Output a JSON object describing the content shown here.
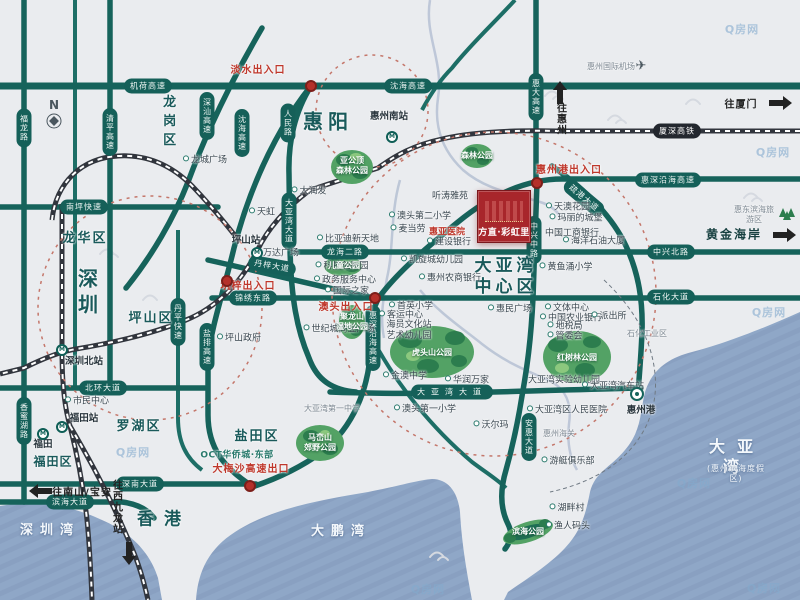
{
  "project": {
    "name": "方直·彩虹里"
  },
  "compass": {
    "label": "N"
  },
  "icons": {
    "plane": "✈"
  },
  "watermark": {
    "text": "Q房网",
    "positions": [
      [
        742,
        29
      ],
      [
        773,
        152
      ],
      [
        769,
        312
      ],
      [
        694,
        483
      ],
      [
        133,
        452
      ],
      [
        428,
        589
      ],
      [
        764,
        588
      ]
    ]
  },
  "airport": {
    "label": "惠州国际机场",
    "x": 611,
    "y": 67,
    "ix": 641,
    "iy": 66
  },
  "regions": [
    {
      "label": "惠阳",
      "x": 328,
      "y": 122,
      "cls": "xl"
    },
    {
      "label": "深圳",
      "x": 86,
      "y": 294,
      "cls": "xl v"
    },
    {
      "label": "龙岗区",
      "x": 167,
      "y": 123,
      "cls": "md v"
    },
    {
      "label": "龙华区",
      "x": 85,
      "y": 239,
      "cls": "md"
    },
    {
      "label": "坪山区",
      "x": 151,
      "y": 319,
      "cls": "md"
    },
    {
      "label": "罗湖区",
      "x": 139,
      "y": 427,
      "cls": "md"
    },
    {
      "label": "福田区",
      "x": 53,
      "y": 462,
      "cls": "sm"
    },
    {
      "label": "盐田区",
      "x": 257,
      "y": 437,
      "cls": "md"
    },
    {
      "label": "香港",
      "x": 164,
      "y": 520,
      "cls": "lg"
    },
    {
      "label": "大亚湾\n中心区",
      "x": 506,
      "y": 277,
      "cls": "center"
    }
  ],
  "water_labels": [
    {
      "label": "深圳湾",
      "x": 50,
      "y": 531
    },
    {
      "label": "大鹏湾",
      "x": 341,
      "y": 532
    },
    {
      "label": "大亚湾",
      "x": 737,
      "y": 457,
      "big": true
    },
    {
      "label": "(惠州滨海度假区)",
      "x": 736,
      "y": 474,
      "sub": true
    }
  ],
  "road_labels": [
    {
      "label": "机荷高速",
      "x": 148,
      "y": 86,
      "o": "h"
    },
    {
      "label": "沈海高速",
      "x": 408,
      "y": 86,
      "o": "h"
    },
    {
      "label": "南坪快速",
      "x": 84,
      "y": 207,
      "o": "h"
    },
    {
      "label": "北环大道",
      "x": 103,
      "y": 388,
      "o": "h"
    },
    {
      "label": "深南大道",
      "x": 140,
      "y": 484,
      "o": "h"
    },
    {
      "label": "滨海大道",
      "x": 70,
      "y": 502,
      "o": "h"
    },
    {
      "label": "惠深沿海高速",
      "x": 668,
      "y": 180,
      "o": "h"
    },
    {
      "label": "中兴北路",
      "x": 671,
      "y": 252,
      "o": "h"
    },
    {
      "label": "石化大道",
      "x": 671,
      "y": 297,
      "o": "h"
    },
    {
      "label": "龙海二路",
      "x": 345,
      "y": 252,
      "o": "h"
    },
    {
      "label": "锦绣东路",
      "x": 253,
      "y": 298,
      "o": "h"
    },
    {
      "label": "大亚湾大道",
      "x": 452,
      "y": 392,
      "o": "h",
      "sp": true
    },
    {
      "label": "疏港大道",
      "x": 584,
      "y": 198,
      "o": "h",
      "rot": 40
    },
    {
      "label": "丹梓大道",
      "x": 272,
      "y": 266,
      "o": "h",
      "rot": 10
    },
    {
      "label": "人民路",
      "x": 288,
      "y": 123,
      "o": "v"
    },
    {
      "label": "大亚湾大道",
      "x": 289,
      "y": 221,
      "o": "v"
    },
    {
      "label": "沈海高速",
      "x": 242,
      "y": 133,
      "o": "v"
    },
    {
      "label": "深汕高速",
      "x": 207,
      "y": 116,
      "o": "v"
    },
    {
      "label": "清平高速",
      "x": 110,
      "y": 132,
      "o": "v"
    },
    {
      "label": "福龙路",
      "x": 24,
      "y": 128,
      "o": "v"
    },
    {
      "label": "香蜜湖路",
      "x": 24,
      "y": 421,
      "o": "v"
    },
    {
      "label": "丹平快速",
      "x": 178,
      "y": 322,
      "o": "v"
    },
    {
      "label": "盐排高速",
      "x": 207,
      "y": 347,
      "o": "v"
    },
    {
      "label": "惠大高速",
      "x": 536,
      "y": 97,
      "o": "v"
    },
    {
      "label": "中兴中路",
      "x": 534,
      "y": 240,
      "o": "v"
    },
    {
      "label": "安惠大道",
      "x": 529,
      "y": 437,
      "o": "v"
    },
    {
      "label": "惠深沿海高速",
      "x": 373,
      "y": 338,
      "o": "v"
    }
  ],
  "rail_labels": [
    {
      "label": "厦深高铁",
      "x": 677,
      "y": 131
    }
  ],
  "entrances": [
    {
      "label": "淡水出入口",
      "x": 258,
      "y": 71,
      "dx": 311,
      "dy": 86
    },
    {
      "label": "惠州港出入口",
      "x": 569,
      "y": 171,
      "dx": 537,
      "dy": 183
    },
    {
      "label": "澳头出入口",
      "x": 346,
      "y": 308,
      "dx": 375,
      "dy": 298
    },
    {
      "label": "坑梓出入口",
      "x": 248,
      "y": 287,
      "dx": 227,
      "dy": 281
    },
    {
      "label": "大梅沙高速出口",
      "x": 251,
      "y": 470,
      "dx": 250,
      "dy": 486
    }
  ],
  "stations": [
    {
      "label": "惠州南站",
      "x": 389,
      "y": 117,
      "ix": 392,
      "iy": 137
    },
    {
      "label": "坪山站",
      "x": 246,
      "y": 241,
      "ix": 257,
      "iy": 253
    },
    {
      "label": "深圳北站",
      "x": 84,
      "y": 362,
      "ix": 62,
      "iy": 350
    },
    {
      "label": "福田站",
      "x": 84,
      "y": 419,
      "ix": 62,
      "iy": 427
    },
    {
      "label": "福田",
      "x": 43,
      "y": 445,
      "ix": 43,
      "iy": 434
    },
    {
      "label": "惠州港",
      "x": 641,
      "y": 411,
      "ix": 637,
      "iy": 394,
      "red": true,
      "icon": "port"
    }
  ],
  "pois": [
    {
      "label": "龙城广场",
      "x": 205,
      "y": 161
    },
    {
      "label": "天虹",
      "x": 262,
      "y": 213
    },
    {
      "label": "大润发",
      "x": 309,
      "y": 192
    },
    {
      "label": "万达广场",
      "x": 277,
      "y": 254
    },
    {
      "label": "坪山政府",
      "x": 239,
      "y": 339
    },
    {
      "label": "市民中心",
      "x": 87,
      "y": 402
    },
    {
      "label": "比亚迪新天地",
      "x": 348,
      "y": 240
    },
    {
      "label": "科技创新园",
      "x": 342,
      "y": 267
    },
    {
      "label": "政务服务中心",
      "x": 345,
      "y": 281
    },
    {
      "label": "国际之家",
      "x": 347,
      "y": 292
    },
    {
      "label": "世纪城商业广场",
      "x": 339,
      "y": 330
    },
    {
      "label": "澳头第二小学",
      "x": 420,
      "y": 217
    },
    {
      "label": "麦当劳",
      "x": 408,
      "y": 230
    },
    {
      "label": "惠亚医院",
      "x": 447,
      "y": 233,
      "red": true,
      "ico": false
    },
    {
      "label": "建设银行",
      "x": 449,
      "y": 243
    },
    {
      "label": "凯旋城幼儿园",
      "x": 432,
      "y": 261
    },
    {
      "label": "惠州农商银行",
      "x": 450,
      "y": 279
    },
    {
      "label": "首英小学",
      "x": 411,
      "y": 307
    },
    {
      "label": "客运中心",
      "x": 401,
      "y": 316
    },
    {
      "label": "海员文化站\n艺术幼儿园",
      "x": 409,
      "y": 331,
      "ico": false
    },
    {
      "label": "金澳中学",
      "x": 405,
      "y": 377
    },
    {
      "label": "华润万家",
      "x": 467,
      "y": 381
    },
    {
      "label": "澳头第一小学",
      "x": 425,
      "y": 410
    },
    {
      "label": "沃尔玛",
      "x": 491,
      "y": 426
    },
    {
      "label": "惠民广场",
      "x": 510,
      "y": 310
    },
    {
      "label": "听涛雅苑",
      "x": 450,
      "y": 197,
      "ico": false
    },
    {
      "label": "天澳花园",
      "x": 568,
      "y": 208
    },
    {
      "label": "玛丽的城堡",
      "x": 576,
      "y": 219
    },
    {
      "label": "中国工商银行",
      "x": 572,
      "y": 234,
      "ico": false
    },
    {
      "label": "海洋石油大厦",
      "x": 594,
      "y": 242
    },
    {
      "label": "黄鱼涌小学",
      "x": 566,
      "y": 268
    },
    {
      "label": "文体中心",
      "x": 567,
      "y": 309
    },
    {
      "label": "中国农业银行",
      "x": 571,
      "y": 319
    },
    {
      "label": "地税局",
      "x": 565,
      "y": 327
    },
    {
      "label": "管委会",
      "x": 565,
      "y": 337
    },
    {
      "label": "派出所",
      "x": 609,
      "y": 317
    },
    {
      "label": "大亚湾实验幼儿园",
      "x": 564,
      "y": 381,
      "ico": false
    },
    {
      "label": "大亚湾汽车站",
      "x": 613,
      "y": 387
    },
    {
      "label": "大亚湾区人民医院",
      "x": 567,
      "y": 411
    },
    {
      "label": "惠州海关",
      "x": 559,
      "y": 434,
      "tiny": true,
      "ico": false
    },
    {
      "label": "游艇俱乐部",
      "x": 568,
      "y": 462
    },
    {
      "label": "湖畔村",
      "x": 567,
      "y": 509
    },
    {
      "label": "渔人码头",
      "x": 568,
      "y": 527
    },
    {
      "label": "大亚湾第一中学",
      "x": 332,
      "y": 409,
      "tiny": true,
      "ico": false
    },
    {
      "label": "OCT华侨城·东部",
      "x": 237,
      "y": 456,
      "brand": true,
      "ico": false
    },
    {
      "label": "惠东滨海旅游区",
      "x": 754,
      "y": 215,
      "tiny": true,
      "ico": false
    },
    {
      "label": "石化工业区",
      "x": 647,
      "y": 334,
      "tiny": true,
      "ico": false
    }
  ],
  "parks": [
    {
      "label": "虎头山公园",
      "x": 432,
      "y": 353
    },
    {
      "label": "红树林公园",
      "x": 577,
      "y": 358
    },
    {
      "label": "儿童公园",
      "x": 344,
      "y": 266
    },
    {
      "label": "聚龙山\n湿地公园",
      "x": 352,
      "y": 322
    },
    {
      "label": "亚公顶\n森林公园",
      "x": 352,
      "y": 166
    },
    {
      "label": "森林公园",
      "x": 477,
      "y": 156
    },
    {
      "label": "马峦山\n郊野公园",
      "x": 320,
      "y": 443
    },
    {
      "label": "滨海公园",
      "x": 528,
      "y": 532
    }
  ],
  "directions": [
    {
      "label": "往惠州",
      "x": 560,
      "y": 119,
      "dir": "up",
      "v": true,
      "ax": 560,
      "ay": 97
    },
    {
      "label": "往厦门",
      "x": 741,
      "y": 103,
      "dir": "right",
      "ax": 776,
      "ay": 103
    },
    {
      "label": "黄金海岸",
      "x": 734,
      "y": 234,
      "dir": "right",
      "ax": 780,
      "ay": 235,
      "big": true
    },
    {
      "label": "往南山/宝安",
      "x": 82,
      "y": 491,
      "dir": "left",
      "ax": 45,
      "ay": 491
    },
    {
      "label": "往西九龙站",
      "x": 116,
      "y": 507,
      "dir": "down",
      "v": true,
      "ax": 129,
      "ay": 549
    }
  ]
}
